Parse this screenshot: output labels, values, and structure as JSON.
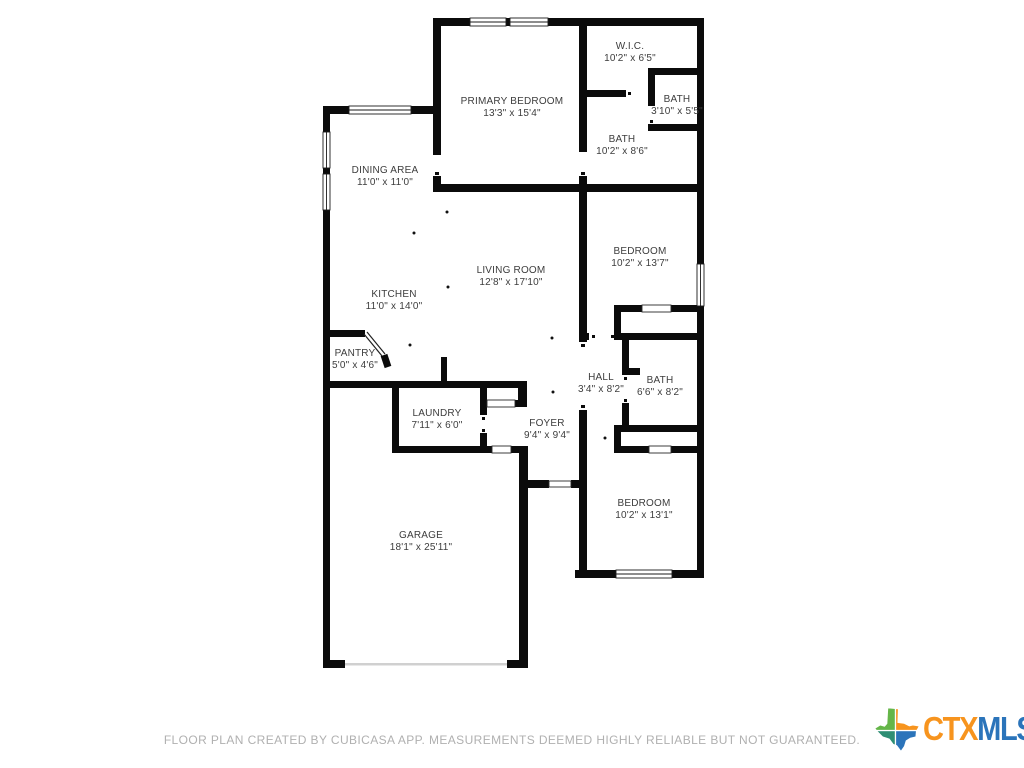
{
  "rooms": [
    {
      "id": "primary-bedroom",
      "name": "PRIMARY BEDROOM",
      "dims": "13'3\" x 15'4\""
    },
    {
      "id": "wic",
      "name": "W.I.C.",
      "dims": "10'2\" x 6'5\""
    },
    {
      "id": "bath-small",
      "name": "BATH",
      "dims": "3'10\" x 5'5\""
    },
    {
      "id": "bath-primary",
      "name": "BATH",
      "dims": "10'2\" x 8'6\""
    },
    {
      "id": "dining-area",
      "name": "DINING AREA",
      "dims": "11'0\" x 11'0\""
    },
    {
      "id": "bedroom-1",
      "name": "BEDROOM",
      "dims": "10'2\" x 13'7\""
    },
    {
      "id": "living-room",
      "name": "LIVING ROOM",
      "dims": "12'8\" x 17'10\""
    },
    {
      "id": "kitchen",
      "name": "KITCHEN",
      "dims": "11'0\" x 14'0\""
    },
    {
      "id": "pantry",
      "name": "PANTRY",
      "dims": "5'0\" x 4'6\""
    },
    {
      "id": "hall",
      "name": "HALL",
      "dims": "3'4\" x 8'2\""
    },
    {
      "id": "bath-hall",
      "name": "BATH",
      "dims": "6'6\" x 8'2\""
    },
    {
      "id": "laundry",
      "name": "LAUNDRY",
      "dims": "7'11\" x 6'0\""
    },
    {
      "id": "foyer",
      "name": "FOYER",
      "dims": "9'4\" x 9'4\""
    },
    {
      "id": "garage",
      "name": "GARAGE",
      "dims": "18'1\" x 25'11\""
    },
    {
      "id": "bedroom-2",
      "name": "BEDROOM",
      "dims": "10'2\" x 13'1\""
    }
  ],
  "footer": {
    "disclaimer": "FLOOR PLAN CREATED BY CUBICASA APP. MEASUREMENTS DEEMED HIGHLY RELIABLE BUT NOT GUARANTEED."
  },
  "logo": {
    "ctx": "CTX",
    "mls": "MLS",
    "colors": {
      "ctx_text": "#f7941e",
      "mls_text": "#2b74ba",
      "texas_top_left": "#65b649",
      "texas_top_right": "#f7941e",
      "texas_bottom_left": "#2e8e74",
      "texas_bottom_right": "#2b74ba"
    }
  },
  "plan": {
    "wall_color": "#0b0b0b",
    "label_color": "#3d3d3d",
    "garage_door_color": "#d0d0d0"
  }
}
